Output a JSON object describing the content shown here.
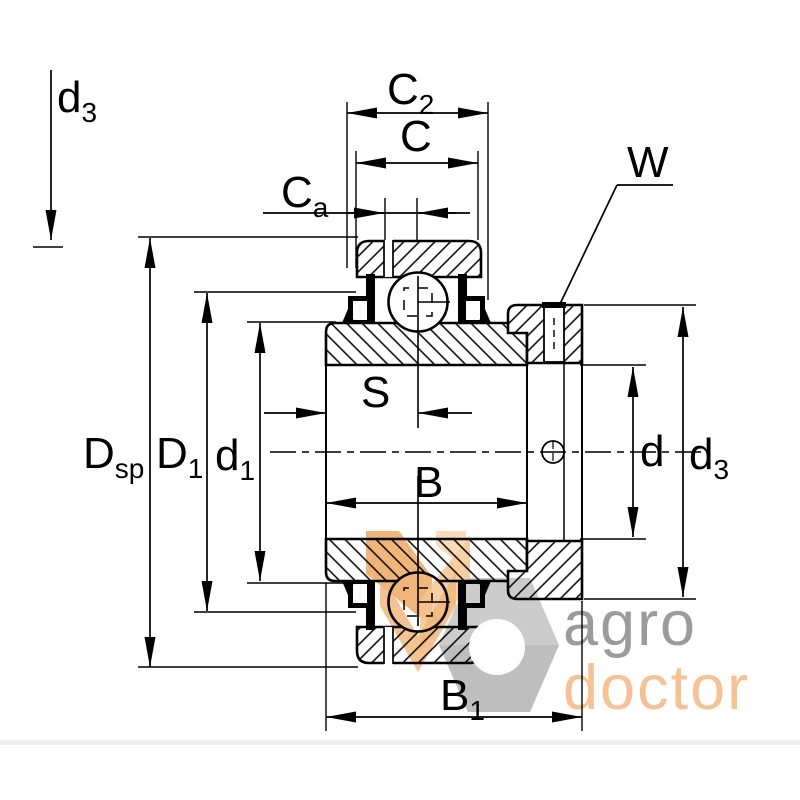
{
  "drawing": {
    "kind": "bearing-cross-section-technical-drawing",
    "labels": {
      "d3_top_left": {
        "main": "d",
        "sub": "3"
      },
      "c2": {
        "main": "C",
        "sub": "2"
      },
      "c": {
        "main": "C",
        "sub": ""
      },
      "ca": {
        "main": "C",
        "sub": "a"
      },
      "w": {
        "main": "W",
        "sub": ""
      },
      "dsp": {
        "main": "D",
        "sub": "sp"
      },
      "d1_outer": {
        "main": "D",
        "sub": "1"
      },
      "d1_bore": {
        "main": "d",
        "sub": "1"
      },
      "s": {
        "main": "S",
        "sub": ""
      },
      "b": {
        "main": "B",
        "sub": ""
      },
      "d_bore": {
        "main": "d",
        "sub": ""
      },
      "d3_right": {
        "main": "d",
        "sub": "3"
      },
      "b1": {
        "main": "B",
        "sub": "1"
      }
    },
    "watermark": {
      "line1": "agro",
      "line2": "doctor",
      "gray_text_color": "#9b9b9b",
      "orange_text_color": "#f8c191",
      "nut_color": "#c9c9c9",
      "wheat_color": "#f0b46f"
    },
    "colors": {
      "line": "#000000",
      "background": "#ffffff"
    }
  }
}
